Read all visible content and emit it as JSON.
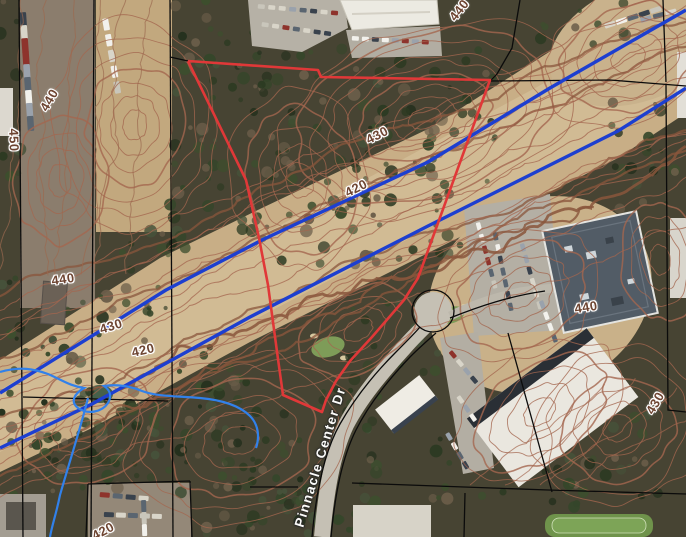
{
  "map": {
    "road_label": "Pinnacle Center Dr",
    "contour_labels": [
      {
        "elevation": "450"
      },
      {
        "elevation": "440"
      },
      {
        "elevation": "440"
      },
      {
        "elevation": "430"
      },
      {
        "elevation": "420"
      },
      {
        "elevation": "430"
      },
      {
        "elevation": "420"
      },
      {
        "elevation": "440"
      },
      {
        "elevation": "440"
      },
      {
        "elevation": "430"
      },
      {
        "elevation": "420"
      }
    ],
    "colors": {
      "parcel_highlight": "#e03838",
      "water_main": "#1d3fd0",
      "stream": "#3181ea",
      "contour": "#a4664f",
      "contour_index": "#8a563c",
      "parcel_line": "#0b0b0b"
    }
  }
}
